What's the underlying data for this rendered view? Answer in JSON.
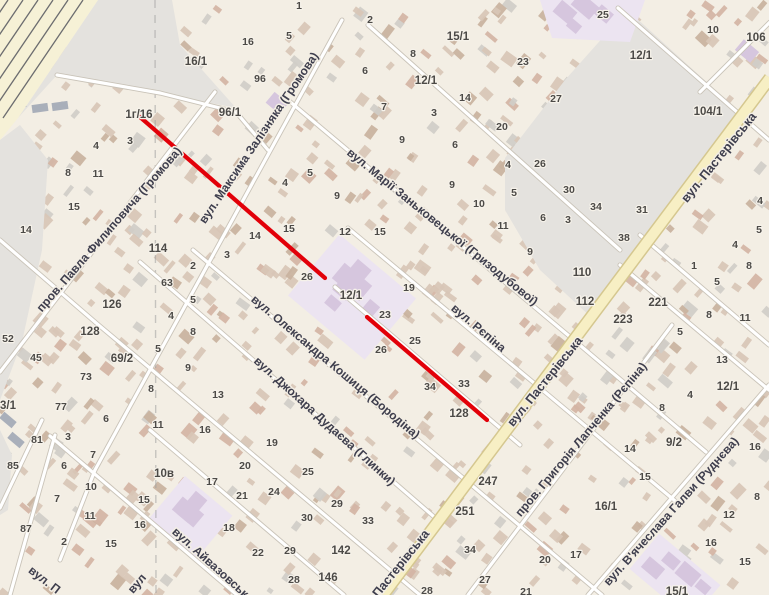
{
  "map": {
    "colors": {
      "base": "#f3eee4",
      "gray_area": "#e4e2de",
      "railway_bg": "#f6f1d6",
      "rail_line": "#55575e",
      "rail_building": "#a9afba",
      "road_fill": "#ffffff",
      "road_casing": "#c9c3b8",
      "main_road_fill": "#f7efc4",
      "main_road_casing": "#d5c78f",
      "purple_area": "#ece4f1",
      "purple_building": "#d6c6de",
      "boundary_dash": "#a0a0a0",
      "route_red": "#e20009",
      "street_text": "#3e3e4d",
      "street_halo": "#f3eee4",
      "number_text": "#4c4a47",
      "number_halo": "#f6f2ea",
      "building_tan": "#d8c6b6",
      "building_dark": "#c9b29e",
      "building_gray": "#d0cdc8",
      "building_red": "#d4b4a4"
    },
    "route": {
      "color": "#e20009",
      "width": 4.2,
      "segments": [
        [
          140,
          117,
          325,
          278
        ],
        [
          367,
          317,
          487,
          420
        ]
      ]
    },
    "street_labels": [
      {
        "label": "пров. Павла Филиповича (Громова)",
        "x": 112,
        "y": 232,
        "angle": -49,
        "size": 12
      },
      {
        "label": "вул. Максима Залізняка (Громова)",
        "x": 262,
        "y": 140,
        "angle": -56,
        "size": 12
      },
      {
        "label": "вул. Марії Заньковецької (Гризодубової)",
        "x": 440,
        "y": 230,
        "angle": 39,
        "size": 12
      },
      {
        "label": "вул. Рєпіна",
        "x": 476,
        "y": 331,
        "angle": 40,
        "size": 12
      },
      {
        "label": "вул. Олександра Кошиця (Бородіна)",
        "x": 333,
        "y": 370,
        "angle": 40,
        "size": 12
      },
      {
        "label": "вул. Джохара Дудаєва (Глинки)",
        "x": 322,
        "y": 424,
        "angle": 42,
        "size": 12
      },
      {
        "label": "вул. Айвазовського",
        "x": 215,
        "y": 572,
        "angle": 42,
        "size": 12
      },
      {
        "label": "вул. Пастерівська",
        "x": 722,
        "y": 160,
        "angle": -51,
        "size": 12.5
      },
      {
        "label": "вул. Пастерівська",
        "x": 548,
        "y": 384,
        "angle": -51,
        "size": 12.5
      },
      {
        "label": "Пастерівська",
        "x": 404,
        "y": 566,
        "angle": -51,
        "size": 12.5
      },
      {
        "label": "пров. Григорія Лапченка (Рєпіна)",
        "x": 584,
        "y": 442,
        "angle": -50,
        "size": 12
      },
      {
        "label": "вул. В'ячеслава Галви (Руднєва)",
        "x": 674,
        "y": 514,
        "angle": -48,
        "size": 12
      },
      {
        "label": "вул. П",
        "x": 42,
        "y": 583,
        "angle": 38,
        "size": 12
      },
      {
        "label": "вул",
        "x": 140,
        "y": 586,
        "angle": -50,
        "size": 12
      }
    ],
    "house_numbers": [
      [
        "16",
        248,
        42
      ],
      [
        "96",
        260,
        79
      ],
      [
        "16/1",
        196,
        62
      ],
      [
        "96/1",
        230,
        113
      ],
      [
        "1г/16",
        139,
        115
      ],
      [
        "3",
        130,
        141
      ],
      [
        "4",
        96,
        146
      ],
      [
        "1",
        299,
        6
      ],
      [
        "5",
        289,
        36
      ],
      [
        "2",
        370,
        20
      ],
      [
        "15/1",
        458,
        37
      ],
      [
        "8",
        413,
        54
      ],
      [
        "12/1",
        426,
        81
      ],
      [
        "14",
        465,
        98
      ],
      [
        "6",
        365,
        71
      ],
      [
        "7",
        384,
        107
      ],
      [
        "3",
        434,
        113
      ],
      [
        "20",
        502,
        127
      ],
      [
        "9",
        402,
        140
      ],
      [
        "6",
        455,
        145
      ],
      [
        "25",
        603,
        15
      ],
      [
        "10",
        713,
        30
      ],
      [
        "106",
        756,
        38
      ],
      [
        "23",
        523,
        62
      ],
      [
        "12/1",
        641,
        56
      ],
      [
        "27",
        556,
        99
      ],
      [
        "104/1",
        708,
        112
      ],
      [
        "8",
        68,
        173
      ],
      [
        "11",
        98,
        174
      ],
      [
        "15",
        74,
        207
      ],
      [
        "14",
        26,
        230
      ],
      [
        "114",
        158,
        249
      ],
      [
        "3",
        227,
        255
      ],
      [
        "2",
        193,
        266
      ],
      [
        "63",
        167,
        283
      ],
      [
        "14",
        255,
        236
      ],
      [
        "5",
        310,
        173
      ],
      [
        "4",
        285,
        183
      ],
      [
        "9",
        337,
        196
      ],
      [
        "15",
        289,
        229
      ],
      [
        "12",
        345,
        232
      ],
      [
        "15",
        380,
        232
      ],
      [
        "26",
        307,
        277
      ],
      [
        "12/1",
        351,
        296
      ],
      [
        "19",
        409,
        288
      ],
      [
        "9",
        452,
        185
      ],
      [
        "10",
        479,
        204
      ],
      [
        "11",
        503,
        226
      ],
      [
        "4",
        508,
        165
      ],
      [
        "5",
        514,
        193
      ],
      [
        "26",
        540,
        164
      ],
      [
        "30",
        569,
        190
      ],
      [
        "34",
        596,
        207
      ],
      [
        "3",
        568,
        220
      ],
      [
        "6",
        543,
        218
      ],
      [
        "9",
        530,
        252
      ],
      [
        "110",
        582,
        273
      ],
      [
        "112",
        585,
        302
      ],
      [
        "31",
        642,
        210
      ],
      [
        "38",
        624,
        238
      ],
      [
        "4",
        760,
        201
      ],
      [
        "5",
        759,
        230
      ],
      [
        "4",
        735,
        245
      ],
      [
        "8",
        749,
        266
      ],
      [
        "1",
        694,
        266
      ],
      [
        "5",
        717,
        282
      ],
      [
        "11",
        745,
        318
      ],
      [
        "8",
        709,
        315
      ],
      [
        "13",
        722,
        360
      ],
      [
        "12/1",
        728,
        387
      ],
      [
        "4",
        690,
        395
      ],
      [
        "8",
        662,
        408
      ],
      [
        "5",
        680,
        332
      ],
      [
        "221",
        658,
        303
      ],
      [
        "223",
        623,
        320
      ],
      [
        "52",
        8,
        339
      ],
      [
        "45",
        36,
        358
      ],
      [
        "126",
        112,
        305
      ],
      [
        "128",
        90,
        332
      ],
      [
        "69/2",
        122,
        359
      ],
      [
        "73",
        86,
        377
      ],
      [
        "77",
        61,
        407
      ],
      [
        "81",
        37,
        440
      ],
      [
        "3/1",
        8,
        406
      ],
      [
        "5",
        193,
        300
      ],
      [
        "4",
        171,
        316
      ],
      [
        "8",
        193,
        332
      ],
      [
        "5",
        158,
        349
      ],
      [
        "9",
        188,
        368
      ],
      [
        "8",
        151,
        389
      ],
      [
        "13",
        218,
        395
      ],
      [
        "6",
        106,
        419
      ],
      [
        "11",
        158,
        425
      ],
      [
        "16",
        205,
        430
      ],
      [
        "3",
        68,
        437
      ],
      [
        "23",
        385,
        315
      ],
      [
        "25",
        415,
        341
      ],
      [
        "26",
        381,
        350
      ],
      [
        "34",
        430,
        387
      ],
      [
        "33",
        464,
        384
      ],
      [
        "128",
        459,
        414
      ],
      [
        "85",
        13,
        466
      ],
      [
        "87",
        26,
        529
      ],
      [
        "7",
        93,
        455
      ],
      [
        "6",
        64,
        466
      ],
      [
        "10",
        91,
        487
      ],
      [
        "7",
        57,
        499
      ],
      [
        "11",
        90,
        516
      ],
      [
        "2",
        64,
        542
      ],
      [
        "15",
        111,
        544
      ],
      [
        "10в",
        164,
        474
      ],
      [
        "15",
        144,
        500
      ],
      [
        "16",
        140,
        525
      ],
      [
        "17",
        212,
        482
      ],
      [
        "20",
        245,
        466
      ],
      [
        "21",
        242,
        496
      ],
      [
        "18",
        229,
        528
      ],
      [
        "19",
        272,
        443
      ],
      [
        "25",
        308,
        472
      ],
      [
        "24",
        274,
        492
      ],
      [
        "29",
        337,
        504
      ],
      [
        "30",
        307,
        518
      ],
      [
        "33",
        368,
        521
      ],
      [
        "29",
        290,
        551
      ],
      [
        "22",
        258,
        553
      ],
      [
        "142",
        341,
        551
      ],
      [
        "146",
        328,
        578
      ],
      [
        "28",
        294,
        580
      ],
      [
        "28",
        427,
        591
      ],
      [
        "247",
        488,
        482
      ],
      [
        "251",
        465,
        512
      ],
      [
        "34",
        470,
        550
      ],
      [
        "27",
        485,
        580
      ],
      [
        "14",
        630,
        449
      ],
      [
        "9/2",
        674,
        443
      ],
      [
        "15",
        645,
        477
      ],
      [
        "16/1",
        606,
        507
      ],
      [
        "12",
        729,
        515
      ],
      [
        "16",
        711,
        543
      ],
      [
        "8",
        757,
        497
      ],
      [
        "15",
        745,
        562
      ],
      [
        "17",
        576,
        555
      ],
      [
        "20",
        545,
        560
      ],
      [
        "15/1",
        677,
        592
      ],
      [
        "21",
        526,
        592
      ],
      [
        "16",
        755,
        447
      ]
    ]
  }
}
